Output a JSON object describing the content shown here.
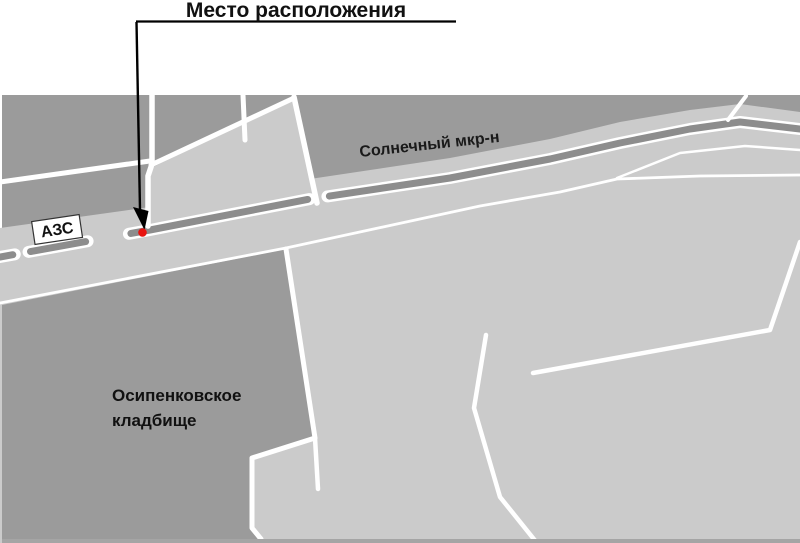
{
  "title": {
    "text": "Место расположения"
  },
  "map": {
    "labels": {
      "gas_station": "АЗС",
      "district": "Солнечный мкр-н",
      "cemetery_line1": "Осипенковское",
      "cemetery_line2": "кладбище"
    },
    "marker": {
      "x": 142.5,
      "y": 232.5,
      "r": 4.3,
      "color": "#e8130f"
    },
    "colors": {
      "background": "#ffffff",
      "block_dark": "#9b9b9b",
      "area_light": "#cbcbcb",
      "road_median": "#8d8d8d",
      "road_white": "#ffffff",
      "bottom_border": "#a5a5a5",
      "callout_line": "#000000"
    }
  }
}
